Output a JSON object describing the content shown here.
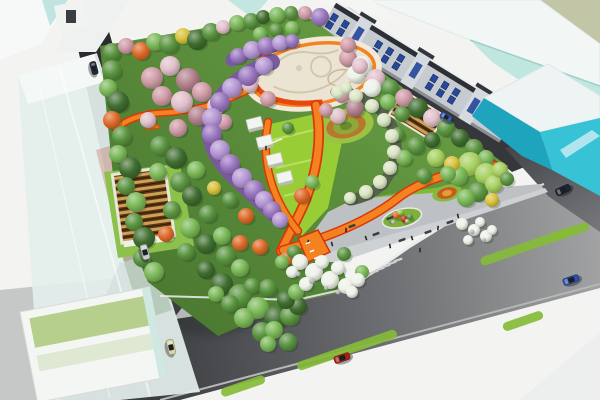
{
  "scene_type": "park-masterplan-aerial-rendering",
  "palette": {
    "sky": "#f3f4f2",
    "roadDark": "#35373b",
    "roadMid": "#6e7074",
    "roadLight": "#a4a6a7",
    "pavement": "#c6c8c7",
    "sidewalk": "#dcdedc",
    "whiteWedge": "#edefee",
    "curb": "#e8eae8",
    "parkGreen": "#5e9140",
    "parkDeep": "#4a7830",
    "lime": "#98cd36",
    "limeDeep": "#7fba36",
    "lawnPanel": "#b7cf8c",
    "plazaCream": "#ece4d2",
    "plazaRing": "#f2ead8",
    "plazaLine": "#d3c6ac",
    "orange": "#f58220",
    "orangeEdge": "#d8380a",
    "orangeRing": "#e8480c",
    "entryPlaza": "#bdc1c4",
    "entryBand": "#cdd1d3",
    "purpleCanopy": "#7a5a9e",
    "pergolaFrame": "#55624a",
    "glassWhite": "#f2f7f5",
    "glassTeal": "#c0e6e0",
    "glassBlue": "#cfe4ea",
    "khaki": "#c3c6a6",
    "cyanFace": "#38c2d6",
    "cyanDeep": "#1ea4bc",
    "shopWall": "#c6cad1",
    "shopRoof": "#2c2f33",
    "shopWindow": "#27489a",
    "pavilionRoof": "#5e3a14",
    "pavilionSlat": "#cfa058",
    "buildingWhite": "#f4f6f4",
    "benchDark": "#3b3f45",
    "person": "#26282a",
    "medianStrip": "#85bb3a",
    "rock": "#b7bab6",
    "treeColors": {
      "g1": "#3f6d2f",
      "g2": "#5a9440",
      "g3": "#7ab857",
      "g4": "#a6cf5f",
      "yl": "#d9c23c",
      "or": "#dd6a28",
      "rd": "#c03818",
      "pk1": "#cf9aa6",
      "pk2": "#e2bfca",
      "pk3": "#b07f8c",
      "pu": "#9a76bf",
      "pu2": "#b596d4",
      "wt": "#eef2e9",
      "wt2": "#dbe6c4",
      "rk": "#b7bab6"
    }
  },
  "trees": [
    [
      112,
      52,
      9,
      "g2"
    ],
    [
      126,
      46,
      8,
      "pk1"
    ],
    [
      141,
      51,
      9,
      "or"
    ],
    [
      155,
      42,
      9,
      "g3"
    ],
    [
      169,
      44,
      10,
      "g2"
    ],
    [
      183,
      36,
      8,
      "yl"
    ],
    [
      197,
      40,
      10,
      "g1"
    ],
    [
      211,
      32,
      9,
      "g2"
    ],
    [
      223,
      27,
      7,
      "pk2"
    ],
    [
      237,
      23,
      8,
      "g3"
    ],
    [
      251,
      21,
      8,
      "g2"
    ],
    [
      263,
      17,
      7,
      "g1"
    ],
    [
      277,
      15,
      8,
      "g3"
    ],
    [
      291,
      13,
      7,
      "g2"
    ],
    [
      305,
      13,
      7,
      "pk1"
    ],
    [
      320,
      17,
      9,
      "pu"
    ],
    [
      260,
      34,
      7,
      "g3"
    ],
    [
      276,
      30,
      7,
      "g2"
    ],
    [
      292,
      28,
      7,
      "g3"
    ],
    [
      348,
      58,
      9,
      "pk1"
    ],
    [
      362,
      66,
      10,
      "wt"
    ],
    [
      376,
      78,
      9,
      "pk2"
    ],
    [
      390,
      88,
      9,
      "g2"
    ],
    [
      404,
      98,
      9,
      "pk1"
    ],
    [
      418,
      108,
      10,
      "g1"
    ],
    [
      432,
      118,
      9,
      "pk2"
    ],
    [
      446,
      128,
      9,
      "g2"
    ],
    [
      460,
      138,
      9,
      "g1"
    ],
    [
      474,
      148,
      9,
      "g2"
    ],
    [
      486,
      158,
      8,
      "g3"
    ],
    [
      356,
      74,
      9,
      "wt"
    ],
    [
      372,
      88,
      9,
      "wt"
    ],
    [
      388,
      102,
      8,
      "g3"
    ],
    [
      402,
      114,
      8,
      "g2"
    ],
    [
      470,
      164,
      12,
      "g4"
    ],
    [
      486,
      174,
      11,
      "g4"
    ],
    [
      458,
      176,
      10,
      "g3"
    ],
    [
      478,
      192,
      10,
      "g2"
    ],
    [
      494,
      184,
      9,
      "g4"
    ],
    [
      466,
      198,
      9,
      "g3"
    ],
    [
      500,
      170,
      8,
      "g4"
    ],
    [
      452,
      164,
      8,
      "yl"
    ],
    [
      492,
      200,
      7,
      "yl"
    ],
    [
      507,
      179,
      7,
      "g2"
    ],
    [
      112,
      70,
      10,
      "g2"
    ],
    [
      108,
      88,
      9,
      "g3"
    ],
    [
      118,
      102,
      11,
      "g1"
    ],
    [
      112,
      120,
      9,
      "or"
    ],
    [
      122,
      136,
      10,
      "g2"
    ],
    [
      118,
      154,
      9,
      "g3"
    ],
    [
      130,
      168,
      11,
      "g1"
    ],
    [
      126,
      186,
      9,
      "g2"
    ],
    [
      136,
      202,
      10,
      "g3"
    ],
    [
      134,
      222,
      9,
      "g2"
    ],
    [
      144,
      238,
      11,
      "g1"
    ],
    [
      142,
      258,
      9,
      "g2"
    ],
    [
      154,
      272,
      10,
      "g3"
    ],
    [
      152,
      78,
      11,
      "pk1"
    ],
    [
      170,
      66,
      10,
      "pk2"
    ],
    [
      188,
      80,
      12,
      "pk3"
    ],
    [
      162,
      96,
      10,
      "pk1"
    ],
    [
      182,
      102,
      11,
      "pk2"
    ],
    [
      202,
      92,
      10,
      "pk1"
    ],
    [
      198,
      116,
      10,
      "pk3"
    ],
    [
      178,
      128,
      9,
      "pk1"
    ],
    [
      216,
      106,
      9,
      "pk2"
    ],
    [
      224,
      122,
      8,
      "pk1"
    ],
    [
      148,
      120,
      8,
      "pk2"
    ],
    [
      160,
      146,
      10,
      "g2"
    ],
    [
      176,
      158,
      11,
      "g1"
    ],
    [
      158,
      172,
      9,
      "g3"
    ],
    [
      180,
      182,
      10,
      "g2"
    ],
    [
      196,
      170,
      9,
      "g3"
    ],
    [
      192,
      196,
      10,
      "g1"
    ],
    [
      172,
      210,
      9,
      "g2"
    ],
    [
      190,
      228,
      10,
      "g3"
    ],
    [
      208,
      214,
      9,
      "g2"
    ],
    [
      206,
      244,
      10,
      "g1"
    ],
    [
      186,
      252,
      9,
      "g2"
    ],
    [
      222,
      236,
      9,
      "g3"
    ],
    [
      226,
      256,
      10,
      "g2"
    ],
    [
      206,
      270,
      9,
      "g1"
    ],
    [
      240,
      268,
      9,
      "g3"
    ],
    [
      166,
      234,
      8,
      "or"
    ],
    [
      246,
      216,
      8,
      "or"
    ],
    [
      214,
      188,
      7,
      "yl"
    ],
    [
      230,
      200,
      8,
      "g2"
    ],
    [
      222,
      284,
      11,
      "g1"
    ],
    [
      240,
      296,
      12,
      "g2"
    ],
    [
      258,
      308,
      11,
      "g3"
    ],
    [
      276,
      318,
      12,
      "g1"
    ],
    [
      290,
      316,
      10,
      "g2"
    ],
    [
      262,
      332,
      10,
      "g2"
    ],
    [
      244,
      318,
      10,
      "g3"
    ],
    [
      274,
      330,
      9,
      "g3"
    ],
    [
      298,
      306,
      9,
      "g1"
    ],
    [
      268,
      288,
      9,
      "g2"
    ],
    [
      286,
      300,
      9,
      "g1"
    ],
    [
      230,
      304,
      9,
      "g2"
    ],
    [
      216,
      294,
      8,
      "g3"
    ],
    [
      252,
      286,
      8,
      "g2"
    ],
    [
      296,
      292,
      8,
      "g3"
    ],
    [
      288,
      342,
      9,
      "g2"
    ],
    [
      268,
      344,
      8,
      "g3"
    ],
    [
      240,
      243,
      8,
      "or"
    ],
    [
      260,
      247,
      8,
      "or"
    ],
    [
      287,
      258,
      7,
      "or"
    ],
    [
      250,
      85,
      8,
      "pk2"
    ],
    [
      268,
      99,
      8,
      "pk1"
    ],
    [
      342,
      94,
      9,
      "pk1"
    ],
    [
      355,
      108,
      9,
      "pk3"
    ],
    [
      338,
      116,
      8,
      "pk2"
    ],
    [
      326,
      110,
      7,
      "pk1"
    ],
    [
      360,
      66,
      8,
      "pk2"
    ],
    [
      348,
      45,
      8,
      "pk1"
    ],
    [
      416,
      146,
      9,
      "g2"
    ],
    [
      432,
      140,
      8,
      "g1"
    ],
    [
      404,
      158,
      8,
      "g3"
    ],
    [
      436,
      158,
      9,
      "g4"
    ],
    [
      424,
      176,
      8,
      "g2"
    ],
    [
      448,
      174,
      8,
      "g3"
    ],
    [
      398,
      134,
      7,
      "g2"
    ],
    [
      302,
      196,
      8,
      "or"
    ],
    [
      312,
      182,
      7,
      "g3"
    ],
    [
      288,
      128,
      6,
      "g2"
    ],
    [
      294,
      252,
      7,
      "g2"
    ],
    [
      362,
      272,
      7,
      "g3"
    ],
    [
      344,
      254,
      7,
      "g2"
    ],
    [
      282,
      262,
      7,
      "g3"
    ],
    [
      300,
      262,
      8,
      "wt"
    ],
    [
      314,
      272,
      9,
      "wt"
    ],
    [
      330,
      280,
      9,
      "wt"
    ],
    [
      346,
      286,
      8,
      "wt"
    ],
    [
      358,
      280,
      7,
      "wt"
    ],
    [
      322,
      262,
      7,
      "wt"
    ],
    [
      338,
      268,
      7,
      "wt"
    ],
    [
      306,
      284,
      7,
      "wt"
    ],
    [
      352,
      292,
      6,
      "wt"
    ],
    [
      292,
      272,
      6,
      "wt"
    ],
    [
      462,
      224,
      6,
      "wt"
    ],
    [
      474,
      230,
      6,
      "wt"
    ],
    [
      486,
      236,
      6,
      "wt"
    ],
    [
      468,
      240,
      5,
      "wt"
    ],
    [
      480,
      222,
      5,
      "wt"
    ],
    [
      492,
      230,
      5,
      "wt"
    ],
    [
      312,
      281,
      3,
      "rk"
    ],
    [
      298,
      274,
      2.5,
      "rk"
    ],
    [
      338,
      292,
      2.5,
      "rk"
    ],
    [
      326,
      288,
      2,
      "rk"
    ],
    [
      472,
      232,
      2.5,
      "rk"
    ],
    [
      484,
      240,
      2,
      "rk"
    ],
    [
      238,
      56,
      8,
      "pu"
    ],
    [
      252,
      50,
      9,
      "pu2"
    ],
    [
      266,
      46,
      9,
      "pu"
    ],
    [
      280,
      43,
      8,
      "pu2"
    ],
    [
      292,
      41,
      7,
      "pu"
    ],
    [
      264,
      66,
      9,
      "pu2"
    ],
    [
      248,
      76,
      10,
      "pu"
    ],
    [
      232,
      88,
      10,
      "pu2"
    ],
    [
      220,
      102,
      10,
      "pu"
    ],
    [
      212,
      118,
      10,
      "pu2"
    ],
    [
      212,
      134,
      10,
      "pu"
    ],
    [
      220,
      150,
      10,
      "pu2"
    ],
    [
      230,
      164,
      10,
      "pu"
    ],
    [
      242,
      178,
      10,
      "pu2"
    ],
    [
      254,
      190,
      10,
      "pu"
    ],
    [
      264,
      200,
      9,
      "pu2"
    ],
    [
      272,
      210,
      9,
      "pu"
    ],
    [
      280,
      220,
      8,
      "pu2"
    ],
    [
      338,
      92,
      7,
      "wt2"
    ],
    [
      346,
      88,
      6,
      "wt2"
    ],
    [
      356,
      96,
      7,
      "wt2"
    ],
    [
      372,
      106,
      7,
      "wt2"
    ],
    [
      384,
      120,
      7,
      "wt2"
    ],
    [
      392,
      136,
      7,
      "wt2"
    ],
    [
      394,
      152,
      7,
      "wt2"
    ],
    [
      390,
      168,
      7,
      "wt2"
    ],
    [
      380,
      182,
      7,
      "wt2"
    ],
    [
      366,
      192,
      7,
      "wt2"
    ],
    [
      350,
      198,
      6,
      "wt2"
    ],
    [
      396,
      215,
      4,
      "or"
    ],
    [
      404,
      219,
      3.5,
      "rd"
    ],
    [
      390,
      219,
      3,
      "g3"
    ],
    [
      410,
      217,
      3,
      "g2"
    ],
    [
      400,
      212,
      3,
      "g4"
    ],
    [
      393,
      222,
      2,
      "rk"
    ],
    [
      407,
      221,
      2,
      "rk"
    ]
  ],
  "orange_paths": [
    {
      "d": "M 252,88 C 222,104 192,112 160,113 C 140,114 124,121 116,129",
      "w": 4.5,
      "ew": 7.5
    },
    {
      "d": "M 316,105 C 322,136 318,170 304,204 C 297,220 288,236 281,251",
      "w": 7,
      "ew": 10.5
    },
    {
      "d": "M 268,122 C 262,152 268,184 284,211 C 288,218 293,225 298,231",
      "w": 5.5,
      "ew": 8.5
    },
    {
      "d": "M 283,250 C 330,237 370,220 398,198 C 420,181 452,171 494,165",
      "w": 6.5,
      "ew": 9.5
    }
  ],
  "tunnel_bases": [
    {
      "d": "M 232,60 C 250,52 270,46 292,42",
      "w": 13
    },
    {
      "d": "M 272,62 C 240,74 216,96 210,120 C 206,146 222,166 240,182 C 252,194 264,204 274,214",
      "w": 16
    }
  ],
  "pergola_base": {
    "d": "M 336,92 C 374,94 398,120 396,150 C 394,178 376,196 350,200",
    "w": 11
  },
  "median_strips": [
    [
      347,
      350,
      105
    ],
    [
      528,
      246,
      100
    ],
    [
      523,
      321,
      42
    ],
    [
      243,
      386,
      46
    ],
    [
      570,
      232,
      40
    ]
  ],
  "cars": [
    [
      94,
      68,
      75,
      "#222c38",
      13,
      6
    ],
    [
      145,
      252,
      75,
      "#c7cbcf",
      15,
      7
    ],
    [
      171,
      347,
      77,
      "#d8d4a2",
      15,
      7
    ],
    [
      342,
      358,
      -19,
      "#a82015",
      16,
      7
    ],
    [
      571,
      280,
      -19,
      "#2f4da8",
      16,
      7
    ],
    [
      563,
      190,
      -25,
      "#1c2634",
      15,
      7
    ],
    [
      446,
      117,
      31,
      "#3b5cb4",
      12,
      6
    ]
  ],
  "benches": [
    [
      352,
      226
    ],
    [
      376,
      234
    ],
    [
      402,
      240
    ],
    [
      428,
      232
    ],
    [
      450,
      222
    ],
    [
      390,
      218
    ]
  ],
  "people": [
    [
      346,
      230
    ],
    [
      366,
      238
    ],
    [
      390,
      246
    ],
    [
      412,
      238
    ],
    [
      438,
      228
    ],
    [
      458,
      216
    ],
    [
      332,
      244
    ],
    [
      420,
      250
    ],
    [
      266,
      148
    ],
    [
      308,
      242
    ]
  ],
  "arrow_dashes": [
    [
      308,
      243
    ],
    [
      312,
      251
    ],
    [
      316,
      258
    ]
  ],
  "crosswalks": [
    {
      "stripes": [
        [
          374,
          272
        ],
        [
          380,
          269
        ],
        [
          386,
          266
        ],
        [
          392,
          263
        ],
        [
          398,
          260
        ]
      ],
      "w": 2.2,
      "h": 9,
      "rot": 71,
      "fill": "#cfd2d2"
    },
    {
      "stripes": [
        [
          264,
          146
        ],
        [
          269,
          144
        ],
        [
          274,
          142
        ],
        [
          279,
          140
        ]
      ],
      "w": 1.6,
      "h": 7,
      "rot": 71,
      "fill": "#eef0ea"
    }
  ],
  "kiosks": [
    [
      246,
      120
    ],
    [
      256,
      138
    ],
    [
      266,
      156
    ],
    [
      276,
      174
    ]
  ],
  "shophouse": {
    "x": 333,
    "y": 8,
    "angle": 31.5,
    "length": 212,
    "height": 26,
    "windowStep": 13,
    "pilasters": [
      28,
      96,
      164
    ]
  },
  "garden_rings": [
    {
      "cx": 346,
      "cy": 126,
      "rot": -12,
      "rings": [
        [
          28,
          17,
          "#9cc244"
        ],
        [
          20,
          12,
          "#b8762e"
        ],
        [
          13,
          8,
          "#90a83a"
        ],
        [
          6,
          4,
          "#6a8a30"
        ]
      ]
    },
    {
      "cx": 447,
      "cy": 193,
      "rot": -14,
      "rings": [
        [
          15,
          8,
          "#88b83c"
        ],
        [
          10,
          5.5,
          "#c85a24"
        ],
        [
          5,
          3,
          "#e0a030"
        ]
      ]
    }
  ]
}
